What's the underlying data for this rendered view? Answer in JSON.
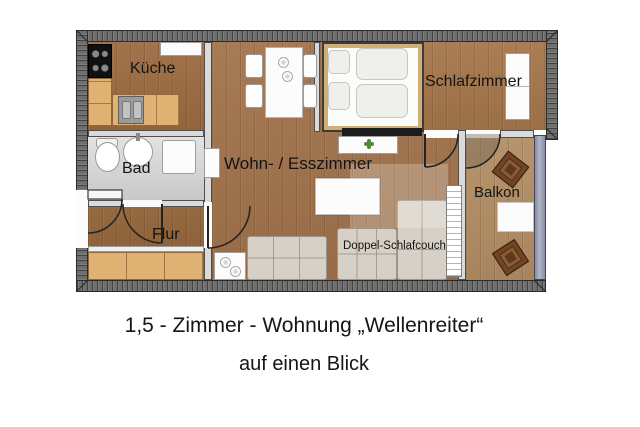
{
  "caption": {
    "title": "1,5 - Zimmer - Wohnung „Wellenreiter“",
    "subtitle": "auf einen Blick"
  },
  "rooms": {
    "kitchen": {
      "label": "Küche"
    },
    "bathroom": {
      "label": "Bad"
    },
    "hallway": {
      "label": "Flur"
    },
    "living": {
      "label": "Wohn- / Esszimmer"
    },
    "bedroom": {
      "label": "Schlafzimmer"
    },
    "balcony": {
      "label": "Balkon"
    }
  },
  "furniture": {
    "sofa_bed": {
      "label": "Doppel-Schlafcouch"
    }
  },
  "colors": {
    "wall-outer": "#6e6e6e",
    "wall-inner": "#dadada",
    "wood-living": "#a1724a",
    "wood-kitchen": "#9c6b40",
    "wood-hall": "#8f6136",
    "wood-bedroom": "#a5764a",
    "wood-balcony": "#b28d63",
    "wood-light": "#e0b274",
    "bath-floor": "#d3d3d3",
    "glass-wall": "#939ab0",
    "couch": "#d6d0c6",
    "chair-brown": "#6f4526",
    "plant-green": "#4e8c37",
    "text": "#141414"
  }
}
